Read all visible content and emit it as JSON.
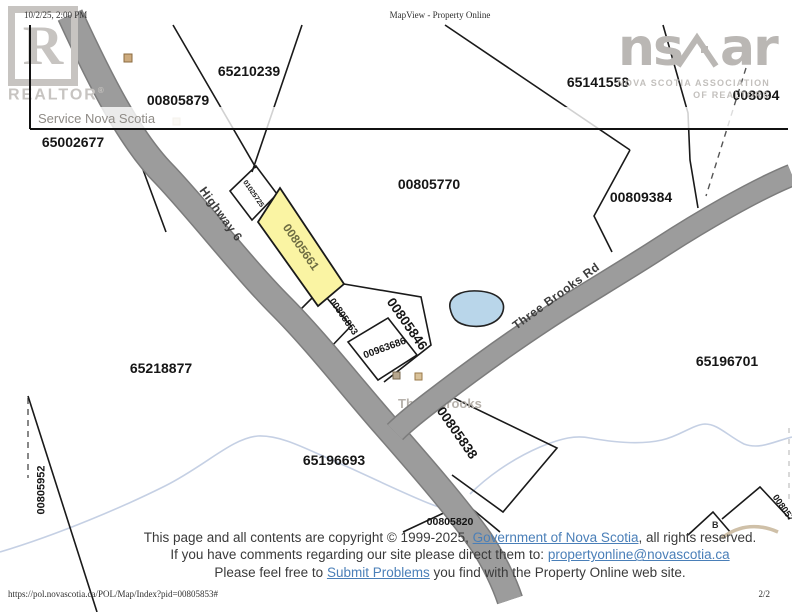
{
  "header": {
    "timestamp": "10/2/25, 2:00 PM",
    "title": "MapView - Property Online"
  },
  "watermarks": {
    "realtor": {
      "letter": "R",
      "label": "REALTOR",
      "reg": "®"
    },
    "nsar": {
      "text_left": "ns",
      "text_right": "ar",
      "caption_line1": "NOVA SCOTIA ASSOCIATION",
      "caption_line2": "OF REALTORS"
    }
  },
  "banner": {
    "service_label": "Service Nova Scotia"
  },
  "map": {
    "roads": [
      {
        "name": "Highway 6"
      },
      {
        "name": "Three Brooks Rd"
      }
    ],
    "place_label": "Three Brooks",
    "building_marker": "B",
    "parcels": [
      {
        "id": "65210239"
      },
      {
        "id": "00805879"
      },
      {
        "id": "65141558"
      },
      {
        "id": "008094"
      },
      {
        "id": "65002677"
      },
      {
        "id": "00805770"
      },
      {
        "id": "00809384"
      },
      {
        "id": "01025725"
      },
      {
        "id": "00805661"
      },
      {
        "id": "00805853"
      },
      {
        "id": "00805846"
      },
      {
        "id": "00963686"
      },
      {
        "id": "65218877"
      },
      {
        "id": "65196701"
      },
      {
        "id": "65196693"
      },
      {
        "id": "00805838"
      },
      {
        "id": "00805820"
      },
      {
        "id": "00805952"
      },
      {
        "id": "008057"
      }
    ],
    "colors": {
      "highlight_parcel": "#faf4a3",
      "road_gray": "#9c9c9c",
      "pond_blue": "#b9d6ea",
      "stream_blue": "#c5d0e4"
    }
  },
  "footer": {
    "line1_prefix": "This page and all contents are copyright © 1999-2025, ",
    "line1_link": "Government of Nova Scotia",
    "line1_suffix": ", all rights reserved.",
    "line2_prefix": "If you have comments regarding our site please direct them to: ",
    "line2_link": "propertyonline@novascotia.ca",
    "line3_prefix": "Please feel free to ",
    "line3_link": "Submit Problems",
    "line3_suffix": " you find with the Property Online web site.",
    "link_color": "#4a7fb8"
  },
  "chrome": {
    "url": "https://pol.novascotia.ca/POL/Map/Index?pid=00805853#",
    "page_indicator": "2/2"
  }
}
